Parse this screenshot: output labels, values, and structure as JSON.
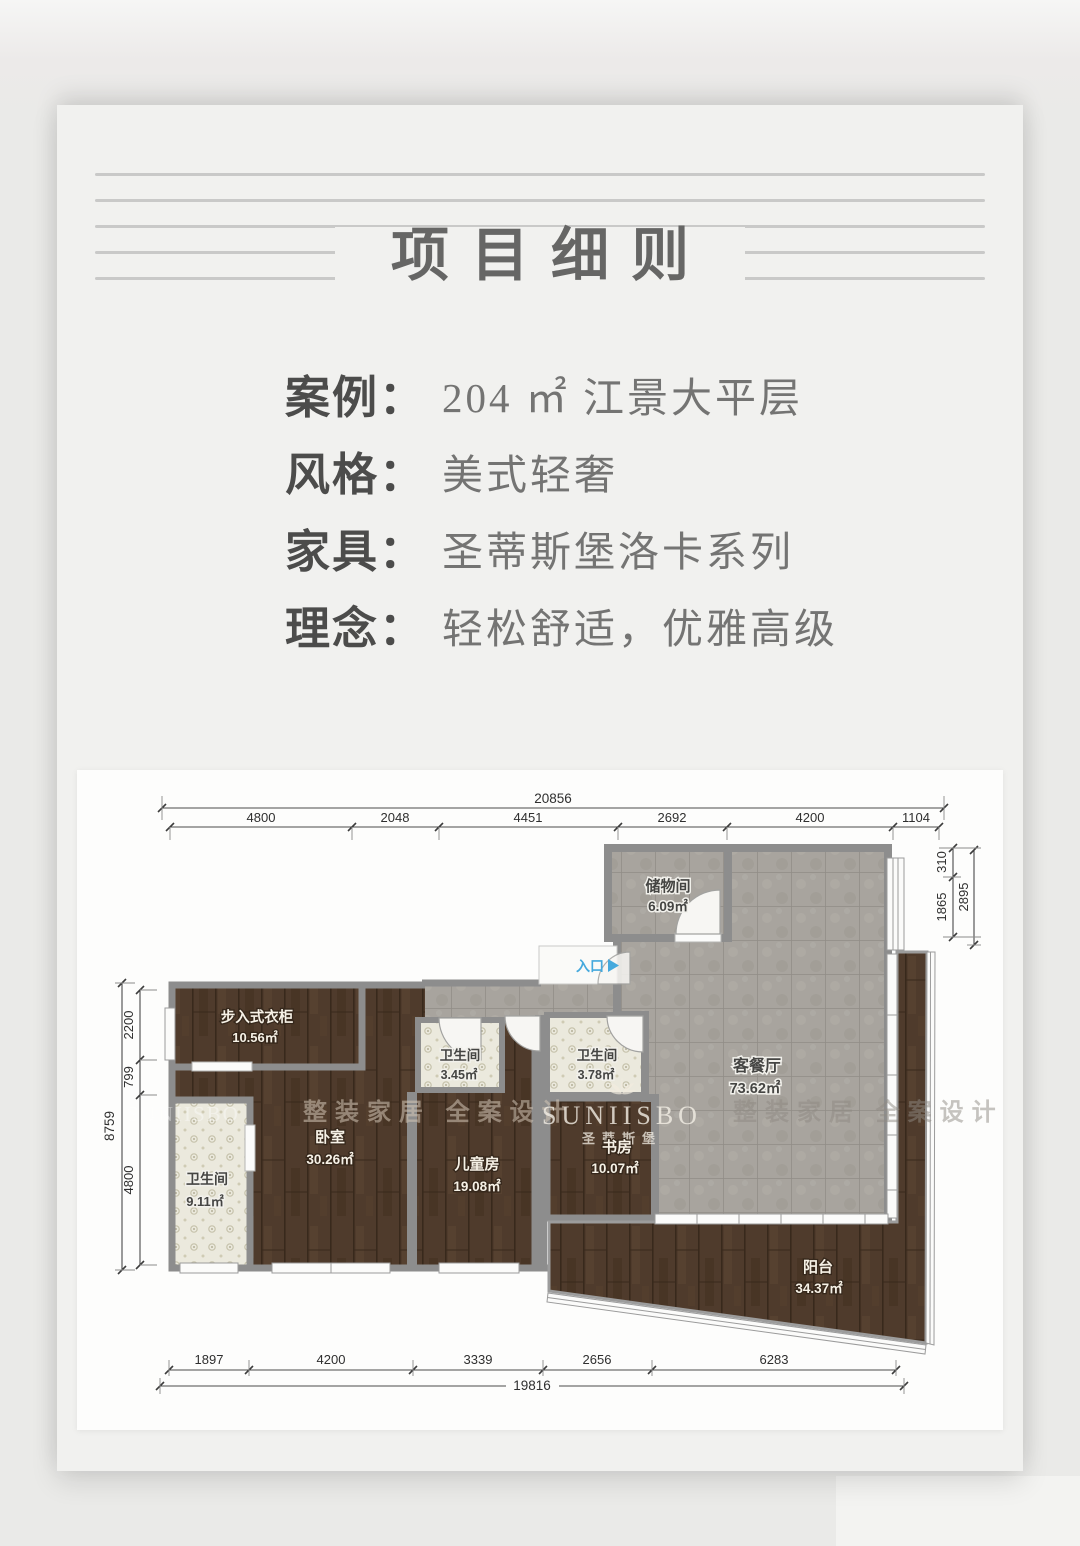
{
  "header": {
    "title": "项目细则"
  },
  "info": {
    "rows": [
      {
        "label": "案例：",
        "value": "204 ㎡ 江景大平层"
      },
      {
        "label": "风格：",
        "value": "美式轻奢"
      },
      {
        "label": "家具：",
        "value": "圣蒂斯堡洛卡系列"
      },
      {
        "label": "理念：",
        "value": "轻松舒适，优雅高级"
      }
    ]
  },
  "floorplan": {
    "entrance_label": "入口",
    "rooms": [
      {
        "name": "储物间",
        "area": "6.09㎡"
      },
      {
        "name": "客餐厅",
        "area": "73.62㎡"
      },
      {
        "name": "步入式衣柜",
        "area": "10.56㎡"
      },
      {
        "name": "卫生间",
        "area": "9.11㎡"
      },
      {
        "name": "卧室",
        "area": "30.26㎡"
      },
      {
        "name": "卫生间",
        "area": "3.45㎡"
      },
      {
        "name": "儿童房",
        "area": "19.08㎡"
      },
      {
        "name": "卫生间",
        "area": "3.78㎡"
      },
      {
        "name": "书房",
        "area": "10.07㎡"
      },
      {
        "name": "阳台",
        "area": "34.37㎡"
      }
    ],
    "dims": {
      "top_total": "20856",
      "top_segments": [
        "4800",
        "2048",
        "4451",
        "2692",
        "4200",
        "1104"
      ],
      "left_total": "8759",
      "left_segments": [
        "2200",
        "799",
        "4800"
      ],
      "right_total": "2895",
      "right_segments": [
        "310",
        "1865"
      ],
      "bottom_total": "19816",
      "bottom_segments": [
        "1897",
        "4200",
        "3339",
        "2656",
        "6283"
      ]
    },
    "watermarks": {
      "brand": "SUNIISBO",
      "brand_cn": "圣蒂斯堡",
      "slogan": "整装家居 全案设计"
    },
    "colors": {
      "wood": "#4f3b2c",
      "tile": "#a7a39d",
      "bath": "#ebe9dd",
      "wall": "#8d8d8d",
      "entrance_blue": "#45a9dd"
    }
  }
}
